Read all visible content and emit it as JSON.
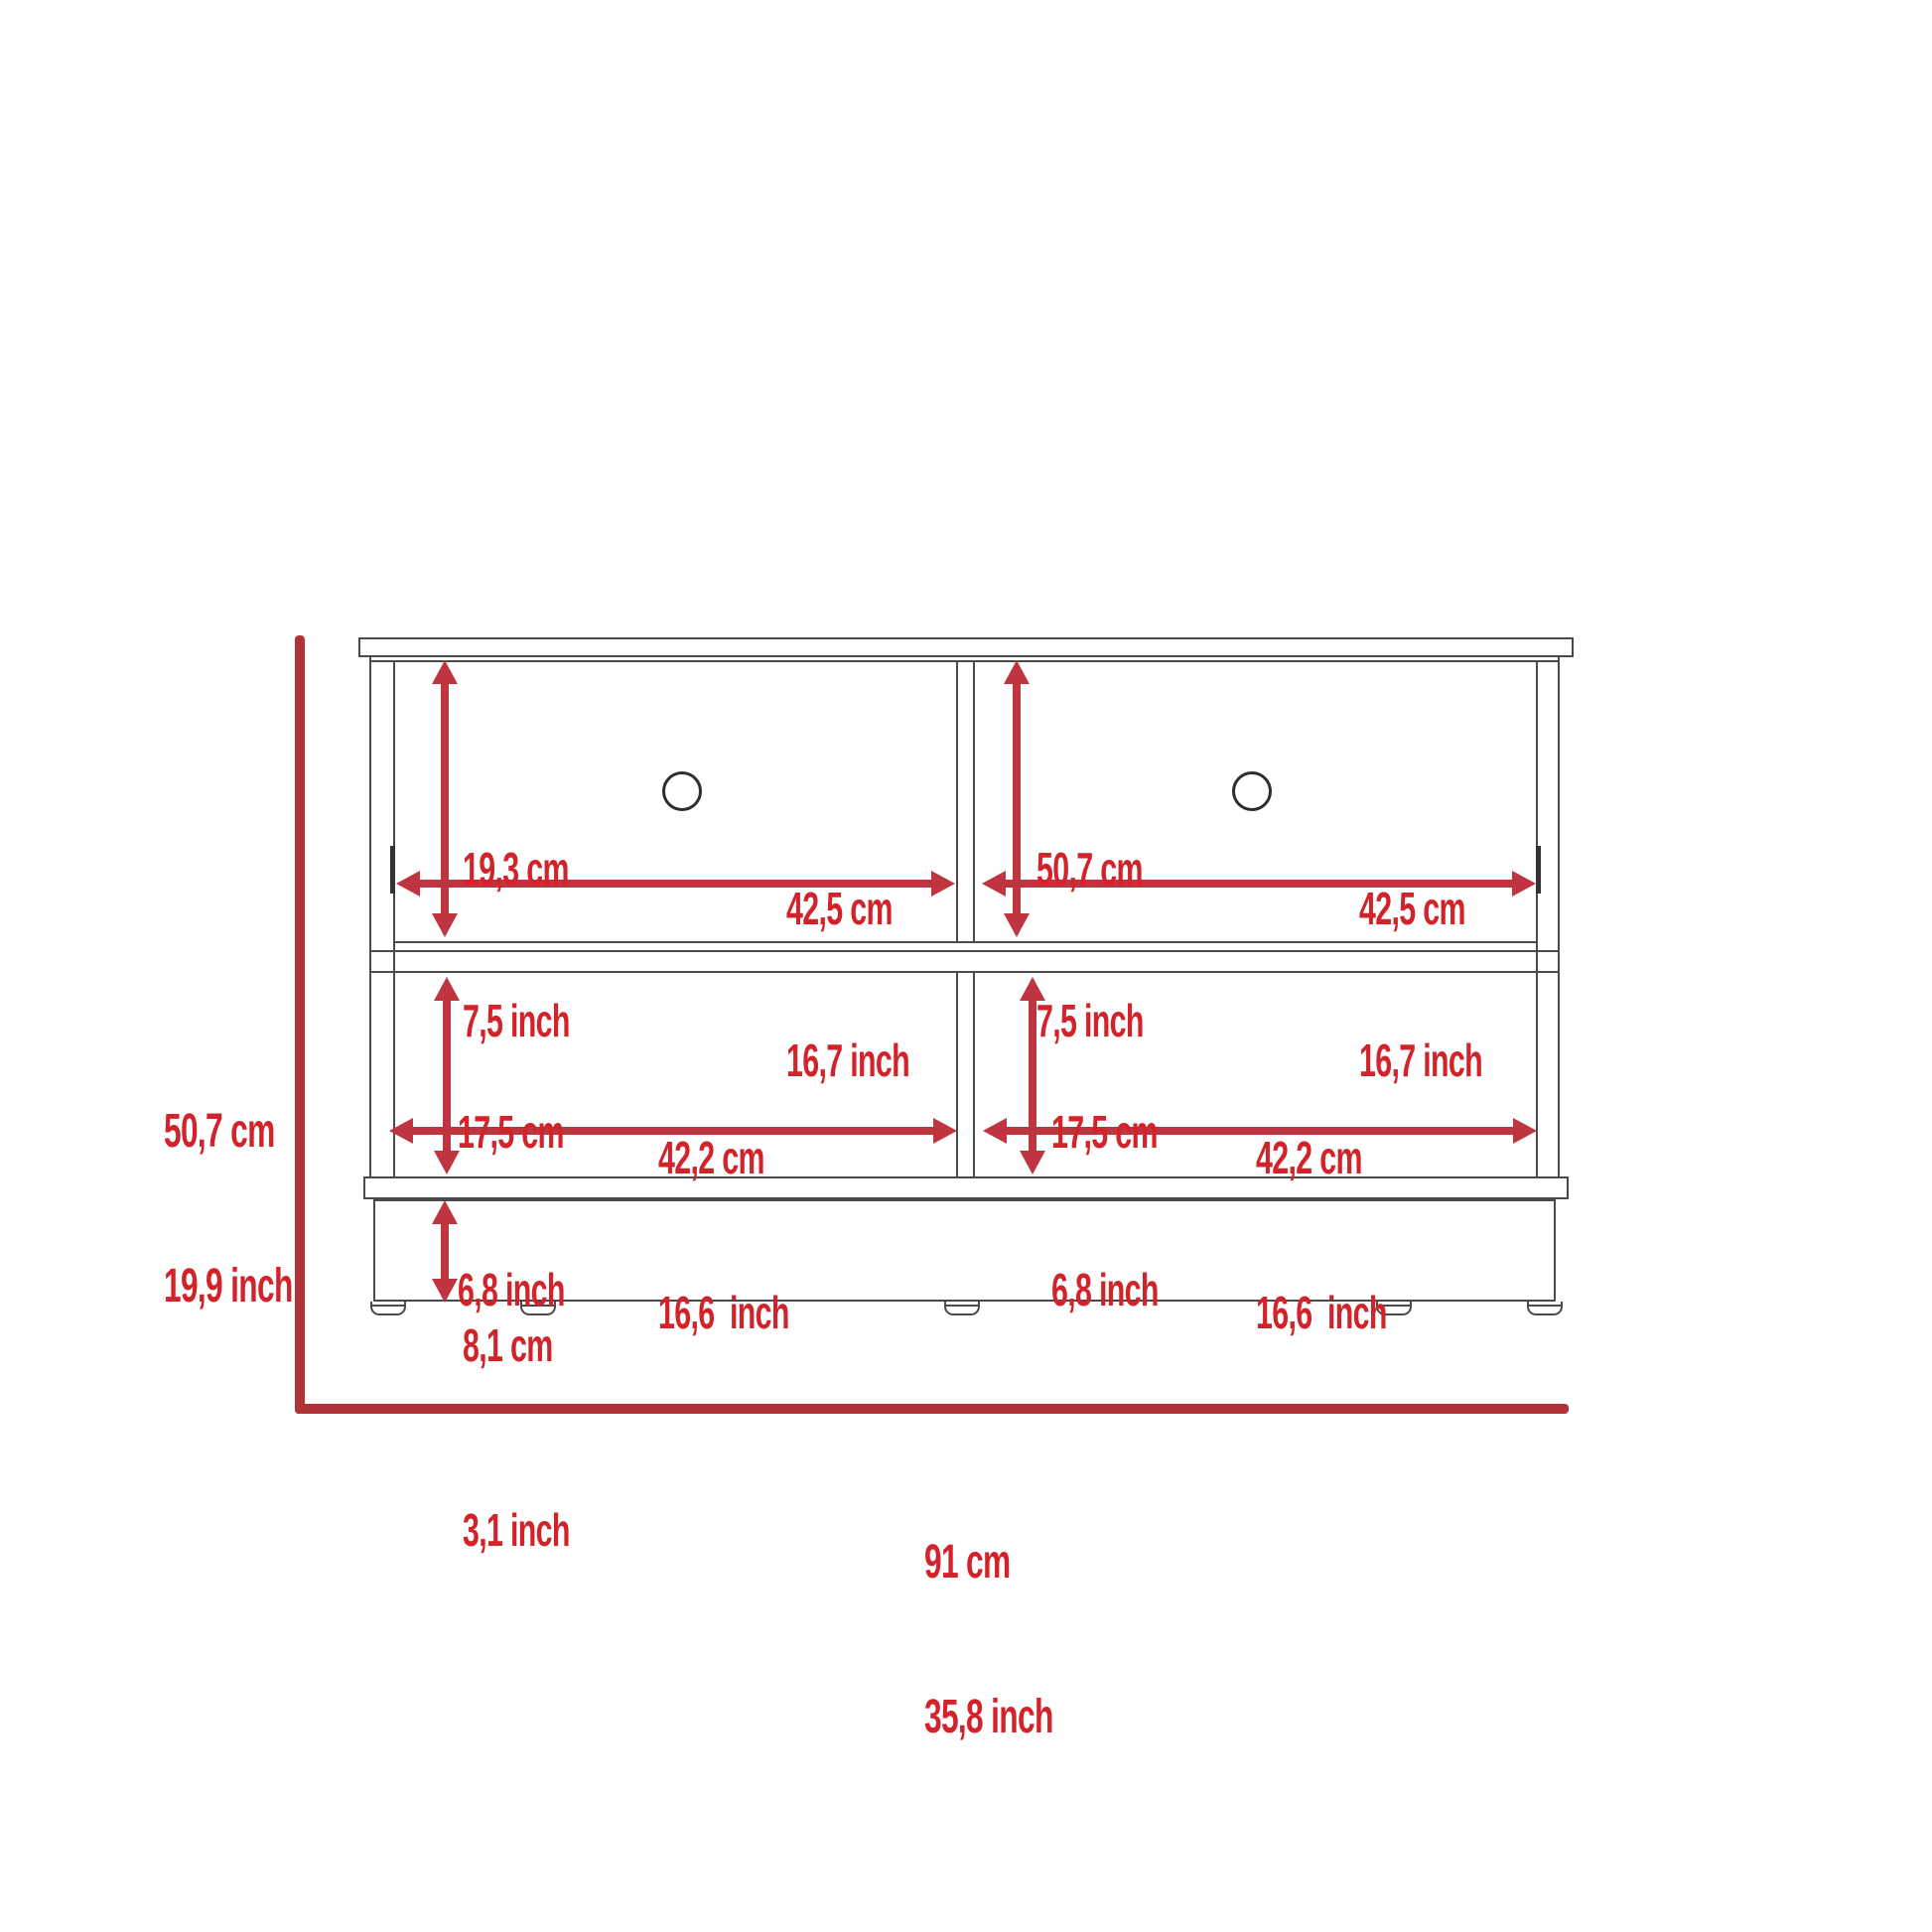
{
  "diagram_type": "furniture-dimension-drawing",
  "colors": {
    "label_red": "#D2232A",
    "arrow_red": "#BE3540",
    "bracket_red": "#B23238",
    "line_gray": "#4A4A4A"
  },
  "dimensions": {
    "overall_height": {
      "cm": "50,7 cm",
      "inch": "19,9 inch"
    },
    "overall_width": {
      "cm": "91 cm",
      "inch": "35,8 inch"
    },
    "left_drawer_height": {
      "cm": "19,3 cm",
      "inch": "7,5 inch"
    },
    "left_drawer_width": {
      "cm": "42,5 cm",
      "inch": "16,7 inch"
    },
    "right_drawer_height": {
      "cm": "50,7 cm",
      "inch": "7,5 inch"
    },
    "right_drawer_width": {
      "cm": "42,5 cm",
      "inch": "16,7 inch"
    },
    "left_shelf_height": {
      "cm": "17,5 cm",
      "inch": "6,8 inch"
    },
    "left_shelf_width": {
      "cm": "42,2 cm",
      "inch": "16,6  inch"
    },
    "right_shelf_height": {
      "cm": "17,5 cm",
      "inch": "6,8 inch"
    },
    "right_shelf_width": {
      "cm": "42,2 cm",
      "inch": "16,6  inch"
    },
    "base_height": {
      "cm": "8,1 cm",
      "inch": "3,1 inch"
    }
  }
}
